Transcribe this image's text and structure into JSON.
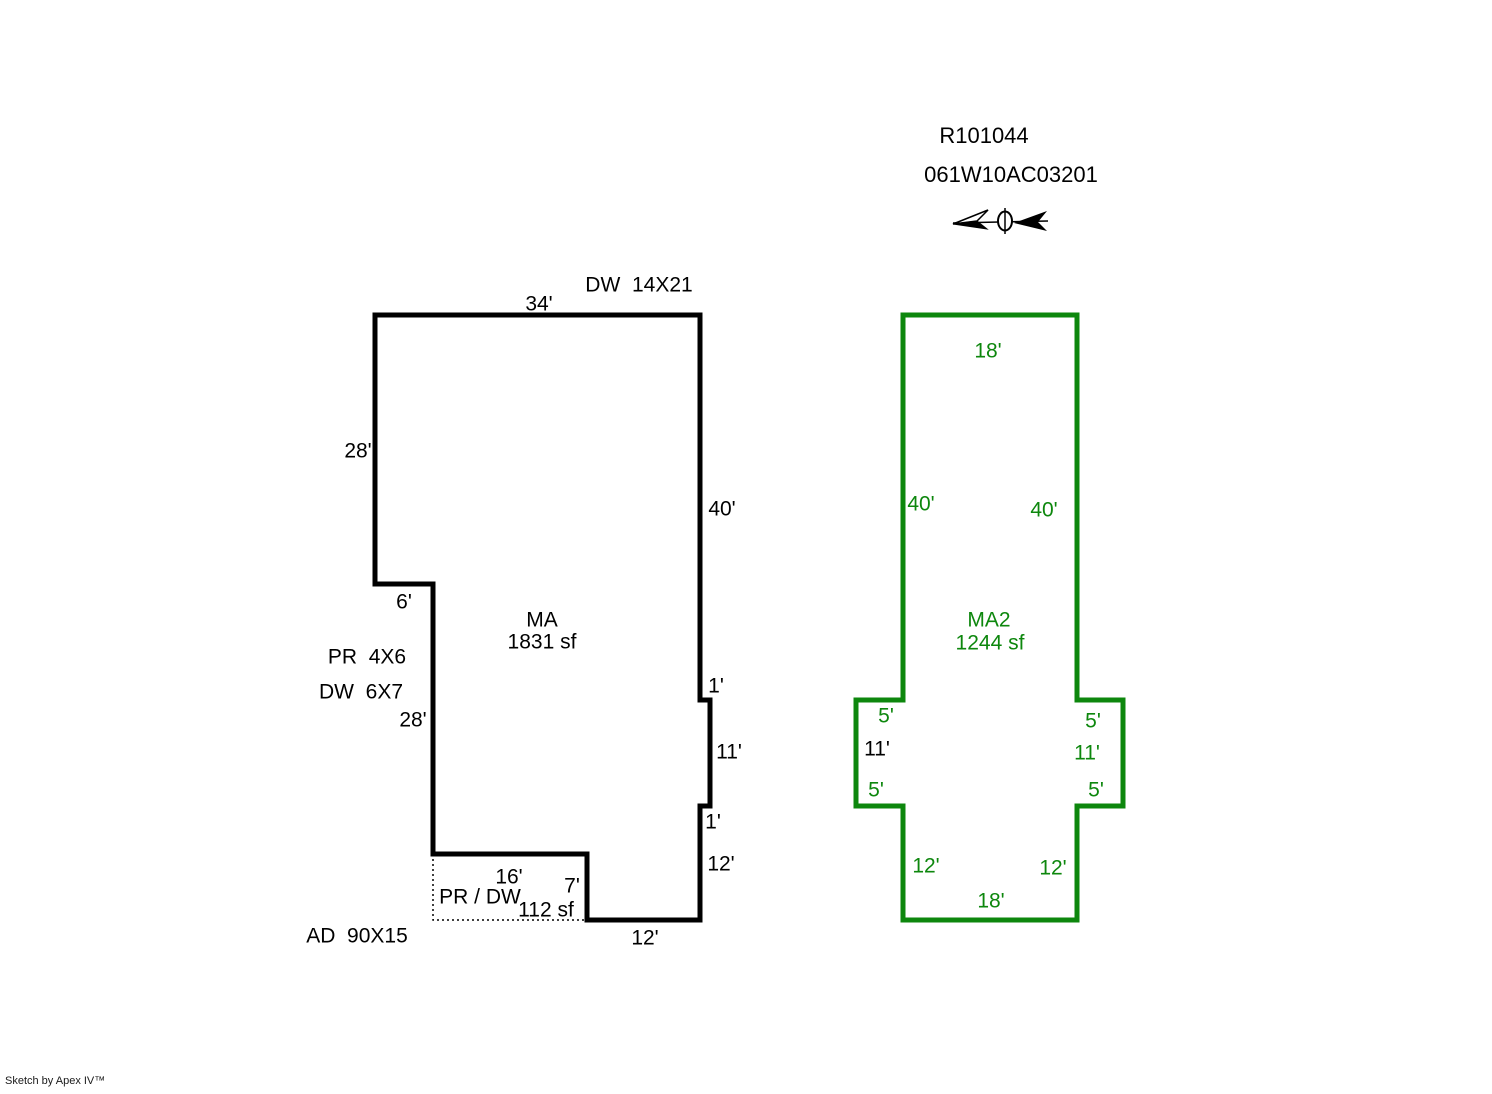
{
  "header": {
    "sketch_id": "R101044",
    "parcel_number": "061W10AC03201"
  },
  "colors": {
    "primary_outline": "#000000",
    "secondary_outline": "#0d870d"
  },
  "ma": {
    "name": "MA",
    "area": "1831 sf",
    "labels": {
      "dw_upper": "DW  14X21",
      "top": "34'",
      "left_upper": "28'",
      "right_upper": "40'",
      "step": "6'",
      "pr": "PR  4X6",
      "dw_lower": "DW  6X7",
      "left_lower": "28'",
      "bump_top": "1'",
      "bump_right": "11'",
      "bump_bottom": "1'",
      "right_lower": "12'",
      "porch_top": "16'",
      "porch_right": "7'",
      "porch_name": "PR / DW",
      "porch_area": "112 sf",
      "bottom": "12'",
      "ad": "AD  90X15"
    }
  },
  "ma2": {
    "name": "MA2",
    "area": "1244 sf",
    "labels": {
      "top": "18'",
      "left": "40'",
      "right": "40'",
      "wing_left_top": "5'",
      "wing_left_side": "11'",
      "wing_left_bottom": "5'",
      "wing_right_top": "5'",
      "wing_right_side": "11'",
      "wing_right_bottom": "5'",
      "bottom_left": "12'",
      "bottom_right": "12'",
      "bottom": "18'"
    }
  },
  "footer": {
    "credit": "Sketch by Apex IV™"
  }
}
